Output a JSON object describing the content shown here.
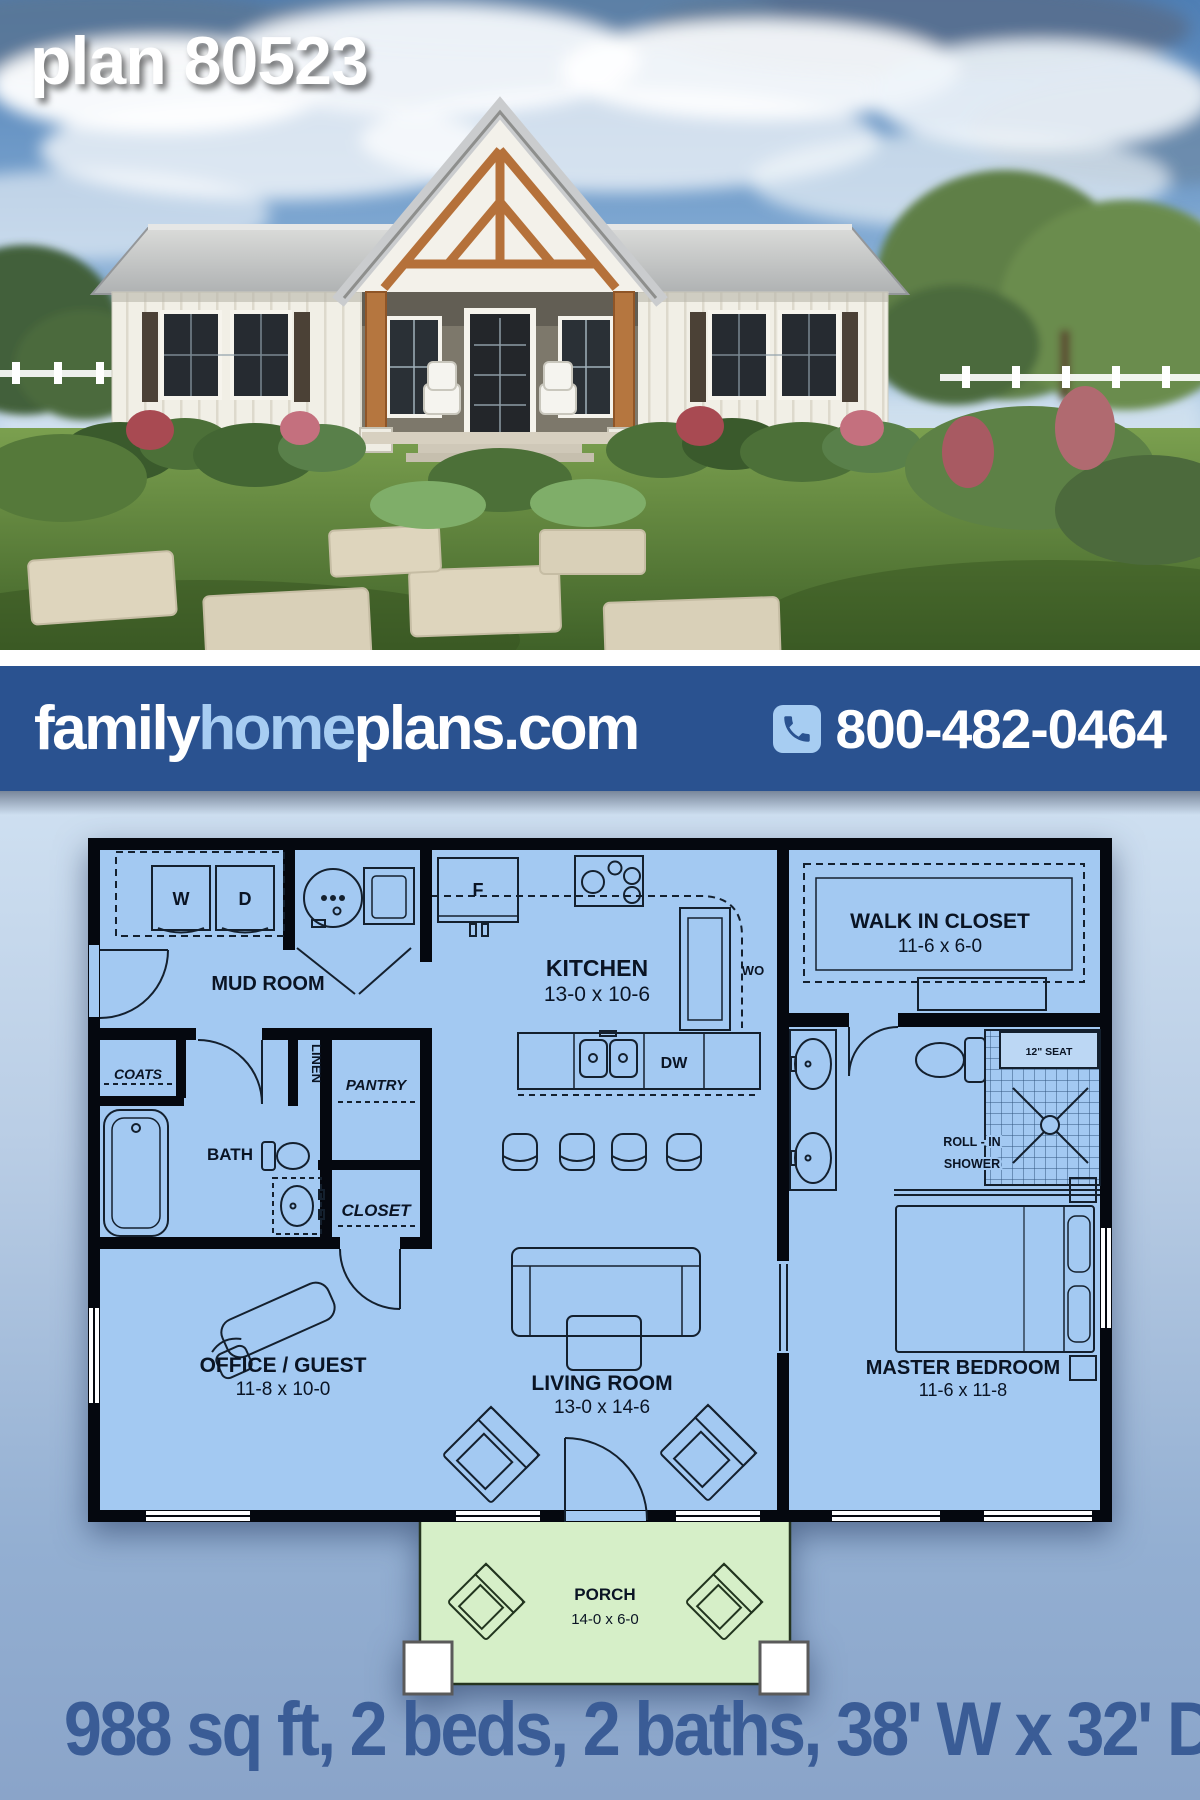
{
  "photo": {
    "plan_label": "plan 80523"
  },
  "banner": {
    "brand_family": "family",
    "brand_home": "home",
    "brand_plans": "plans.com",
    "phone": "800-482-0464"
  },
  "plan": {
    "mud_room": {
      "name": "MUD ROOM"
    },
    "kitchen": {
      "name": "KITCHEN",
      "dims": "13-0 x 10-6"
    },
    "walk_in_closet": {
      "name": "WALK IN CLOSET",
      "dims": "11-6 x 6-0"
    },
    "bath": {
      "name": "BATH"
    },
    "coats": {
      "name": "COATS"
    },
    "linen": {
      "name": "LINEN"
    },
    "pantry": {
      "name": "PANTRY"
    },
    "closet": {
      "name": "CLOSET"
    },
    "office": {
      "name": "OFFICE / GUEST",
      "dims": "11-8 x 10-0"
    },
    "living": {
      "name": "LIVING ROOM",
      "dims": "13-0 x 14-6"
    },
    "master": {
      "name": "MASTER BEDROOM",
      "dims": "11-6 x 11-8"
    },
    "porch": {
      "name": "PORCH",
      "dims": "14-0 x 6-0"
    },
    "shower": {
      "line1": "ROLL - IN",
      "line2": "SHOWER",
      "seat": "12\" SEAT"
    },
    "appliances": {
      "washer": "W",
      "dryer": "D",
      "fridge": "F",
      "wall_oven": "WO",
      "dishwasher": "DW"
    }
  },
  "footer": {
    "stats": "988 sq ft, 2 beds, 2 baths, 38' W x 32' D"
  },
  "colors": {
    "banner_blue": "#2a5290",
    "accent_light_blue": "#a7cdf2",
    "room_blue": "#a3c9f2",
    "porch_green": "#d6efc8",
    "stats_blue": "#3a5c96",
    "wall_black": "#05080f"
  }
}
